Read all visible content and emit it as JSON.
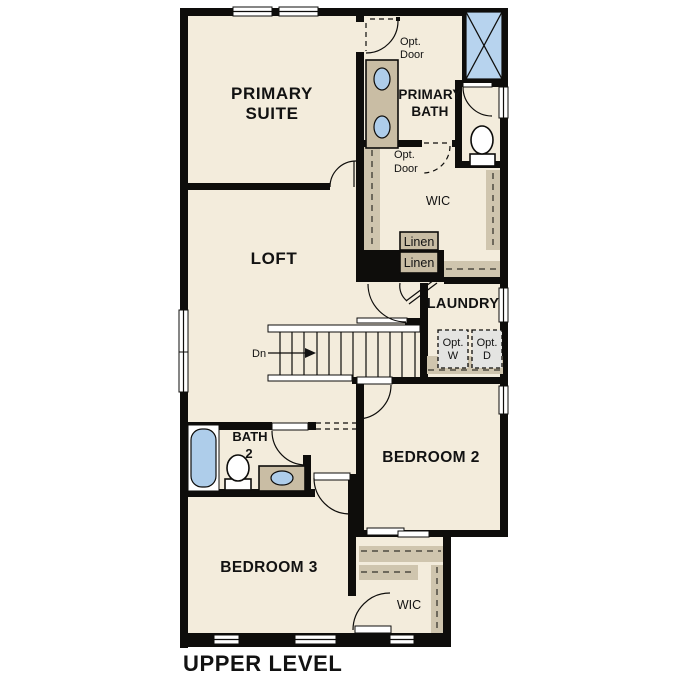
{
  "colors": {
    "wall": "#0e0d0b",
    "room_fill": "#f3ecdc",
    "cabinet": "#c9bda4",
    "shelf": "#cfc5ae",
    "fixture": "#aecdea",
    "shower": "#b7d3ee",
    "optbox": "#e4e4e2",
    "background": "#ffffff"
  },
  "plan": {
    "level_title": "UPPER LEVEL",
    "rooms": {
      "primary_suite": {
        "line1": "PRIMARY",
        "line2": "SUITE"
      },
      "primary_bath": {
        "line1": "PRIMARY",
        "line2": "BATH"
      },
      "loft": {
        "label": "LOFT"
      },
      "laundry": {
        "label": "LAUNDRY"
      },
      "bath2": {
        "line1": "BATH",
        "line2": "2"
      },
      "bedroom2": {
        "label": "BEDROOM 2"
      },
      "bedroom3": {
        "label": "BEDROOM 3"
      },
      "wic_upper": {
        "label": "WIC"
      },
      "wic_lower": {
        "label": "WIC"
      }
    },
    "annotations": {
      "opt_door_upper": {
        "line1": "Opt.",
        "line2": "Door"
      },
      "opt_door_wic": {
        "line1": "Opt.",
        "line2": "Door"
      },
      "linen_upper": "Linen",
      "linen_lower": "Linen",
      "opt_washer": {
        "line1": "Opt.",
        "line2": "W"
      },
      "opt_dryer": {
        "line1": "Opt.",
        "line2": "D"
      },
      "stairs_direction": "Dn"
    }
  }
}
